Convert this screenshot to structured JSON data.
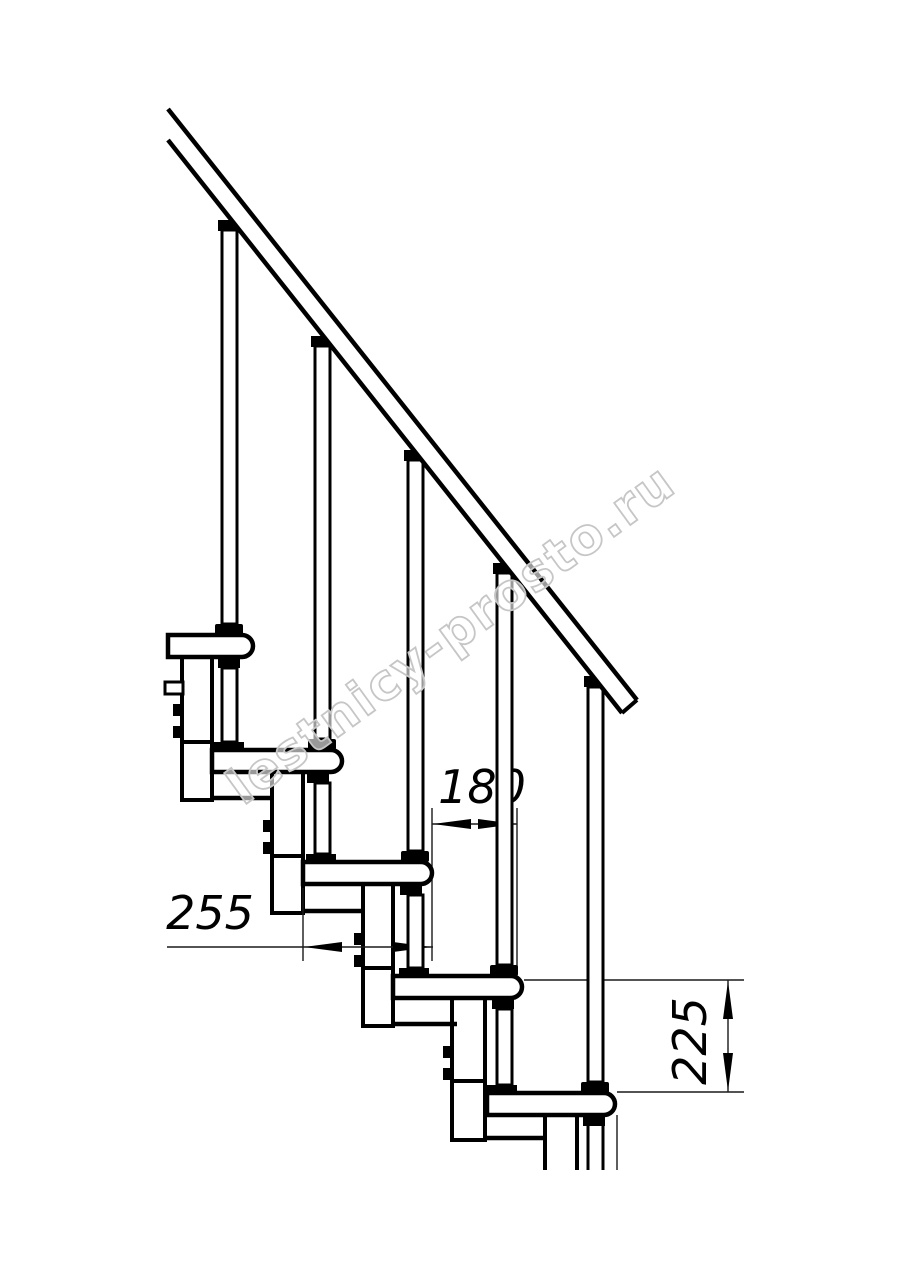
{
  "watermark": {
    "text": "lestnicy-prosto.ru"
  },
  "dimensions": {
    "tread_depth": {
      "value": "255"
    },
    "step_run": {
      "value": "180"
    },
    "step_rise": {
      "value": "225"
    }
  },
  "colors": {
    "line": "#000000",
    "thin_line": "#1a1a1a",
    "watermark_outline": "#c6c6c6",
    "background": "#ffffff"
  }
}
